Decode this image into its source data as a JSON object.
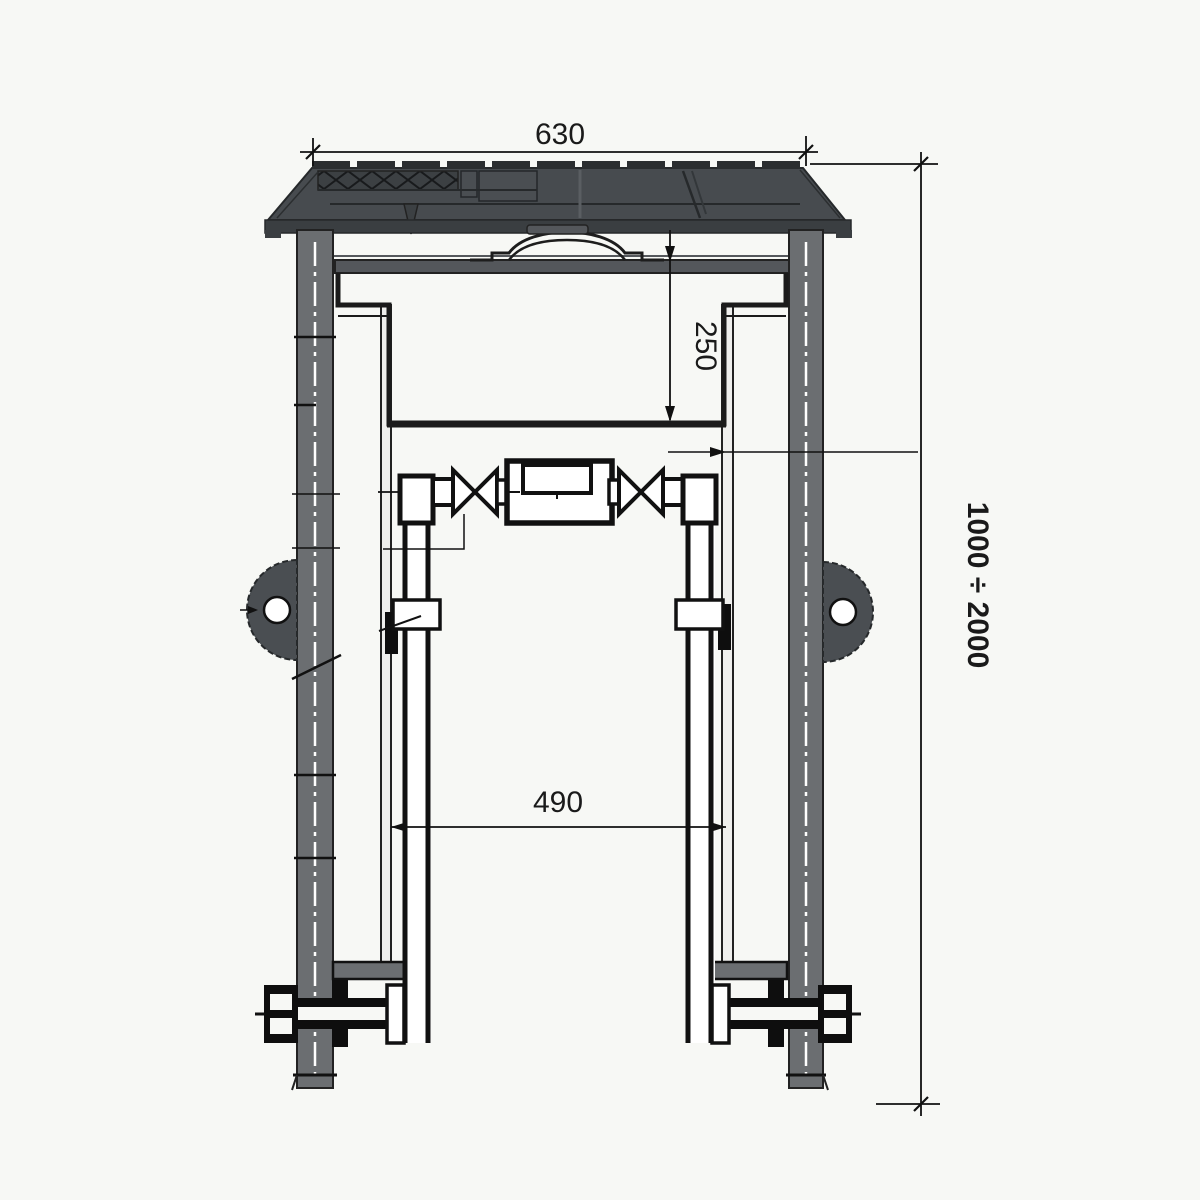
{
  "drawing": {
    "type": "technical-section-drawing",
    "subject": "telescopic-water-meter-pit-cross-section",
    "dimensions": {
      "cover_width": "630",
      "plug_depth": "250",
      "riser_spacing": "490",
      "depth_range": "1000 ÷ 2000"
    },
    "colors": {
      "background": "#f7f8f5",
      "cover_fill": "#474b4f",
      "cover_dark": "#3a3e41",
      "pipe_fill": "#6b6e71",
      "plate_fill": "#54575b",
      "line": "#111111",
      "centerline": "#ffffff"
    }
  }
}
